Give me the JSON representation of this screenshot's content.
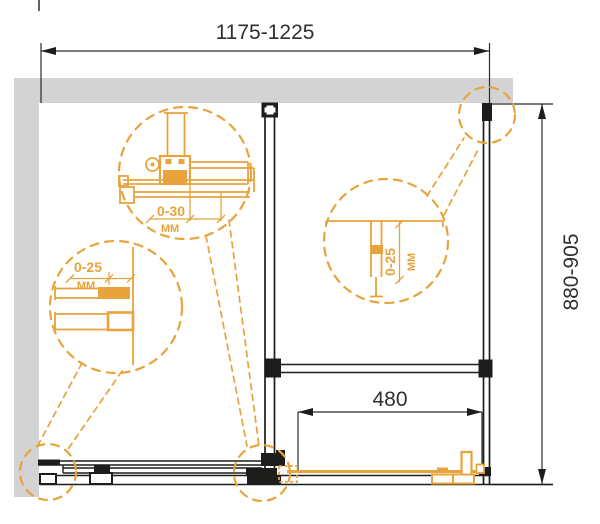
{
  "drawing": {
    "type": "technical-dimension-drawing",
    "subject": "sliding shower enclosure installation scheme (plan view)",
    "dimensions": {
      "width": "1175-1225",
      "depth": "880-905",
      "door_width": "480"
    },
    "adjustments": {
      "top_bracket": {
        "range": "0-30",
        "unit": "MM"
      },
      "left_wall_profile": {
        "range": "0-25",
        "unit": "MM"
      },
      "back_wall_profile": {
        "range": "0-25",
        "unit": "MM"
      }
    },
    "colors": {
      "accent_orange": "#E8A33C",
      "wall_gray": "#D3D3D3",
      "line_black": "#1D1D1B",
      "background": "#FFFFFF"
    }
  }
}
